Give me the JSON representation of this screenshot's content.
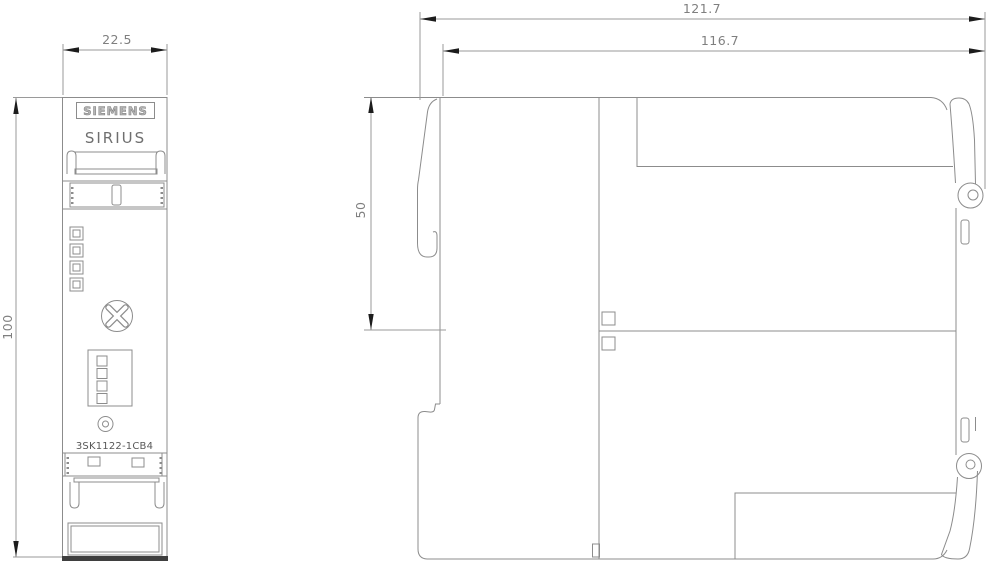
{
  "front_view": {
    "brand_label": "SIEMENS",
    "series_label": "SIRIUS",
    "product_code": "3SK1122-1CB4",
    "width_dim": "22.5",
    "height_dim": "100"
  },
  "side_view": {
    "total_width_dim": "121.7",
    "mounting_width_dim": "116.7",
    "upper_height_dim": "50"
  },
  "colors": {
    "device_line": "#8c8c8c",
    "dimension_line": "#9a9a9a",
    "arrow": "#1c1c1c",
    "label_text": "#7f7f7f",
    "dark_base_edge": "#3f3f3f"
  }
}
